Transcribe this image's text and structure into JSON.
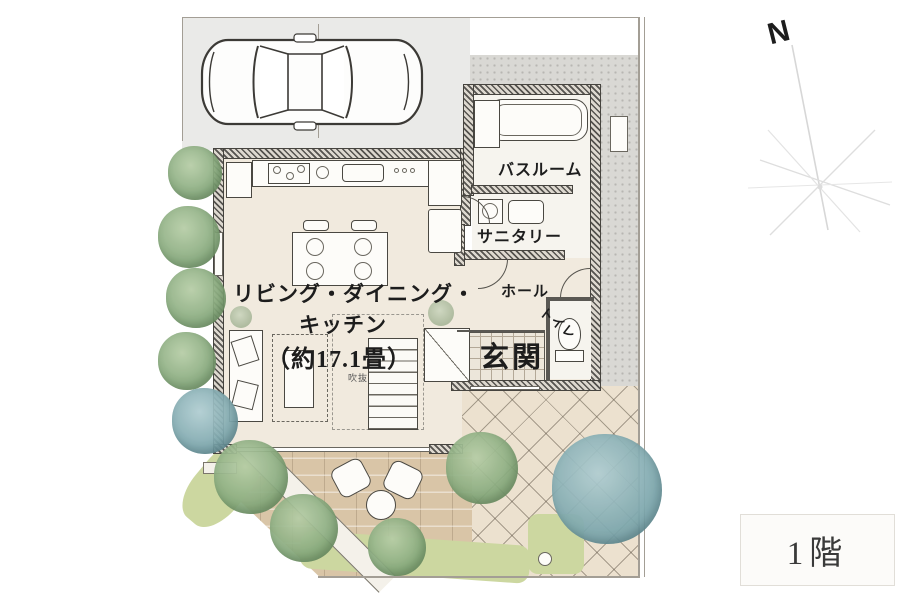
{
  "meta": {
    "floor_badge": "1階",
    "compass_label": "N"
  },
  "rooms": {
    "ldk_line1": "リビング・ダイニング・",
    "ldk_line2": "キッチン",
    "ldk_line3": "（約17.1畳）",
    "void_label": "吹抜",
    "bathroom": "バスルーム",
    "sanitary": "サニタリー",
    "hall": "ホール",
    "toilet": "トイレ",
    "entrance": "玄関"
  },
  "palette": {
    "wall_hatch": "#55534f",
    "floor_cream": "#f1eade",
    "terrace_brick": "#d9c5a7",
    "approach_tile": "#ece1cf",
    "ground_gray": "#d9d8d4",
    "lawn_green": "#ccd7a0",
    "tree_green": "#86a97c",
    "tree_blue": "#7da7ad"
  }
}
